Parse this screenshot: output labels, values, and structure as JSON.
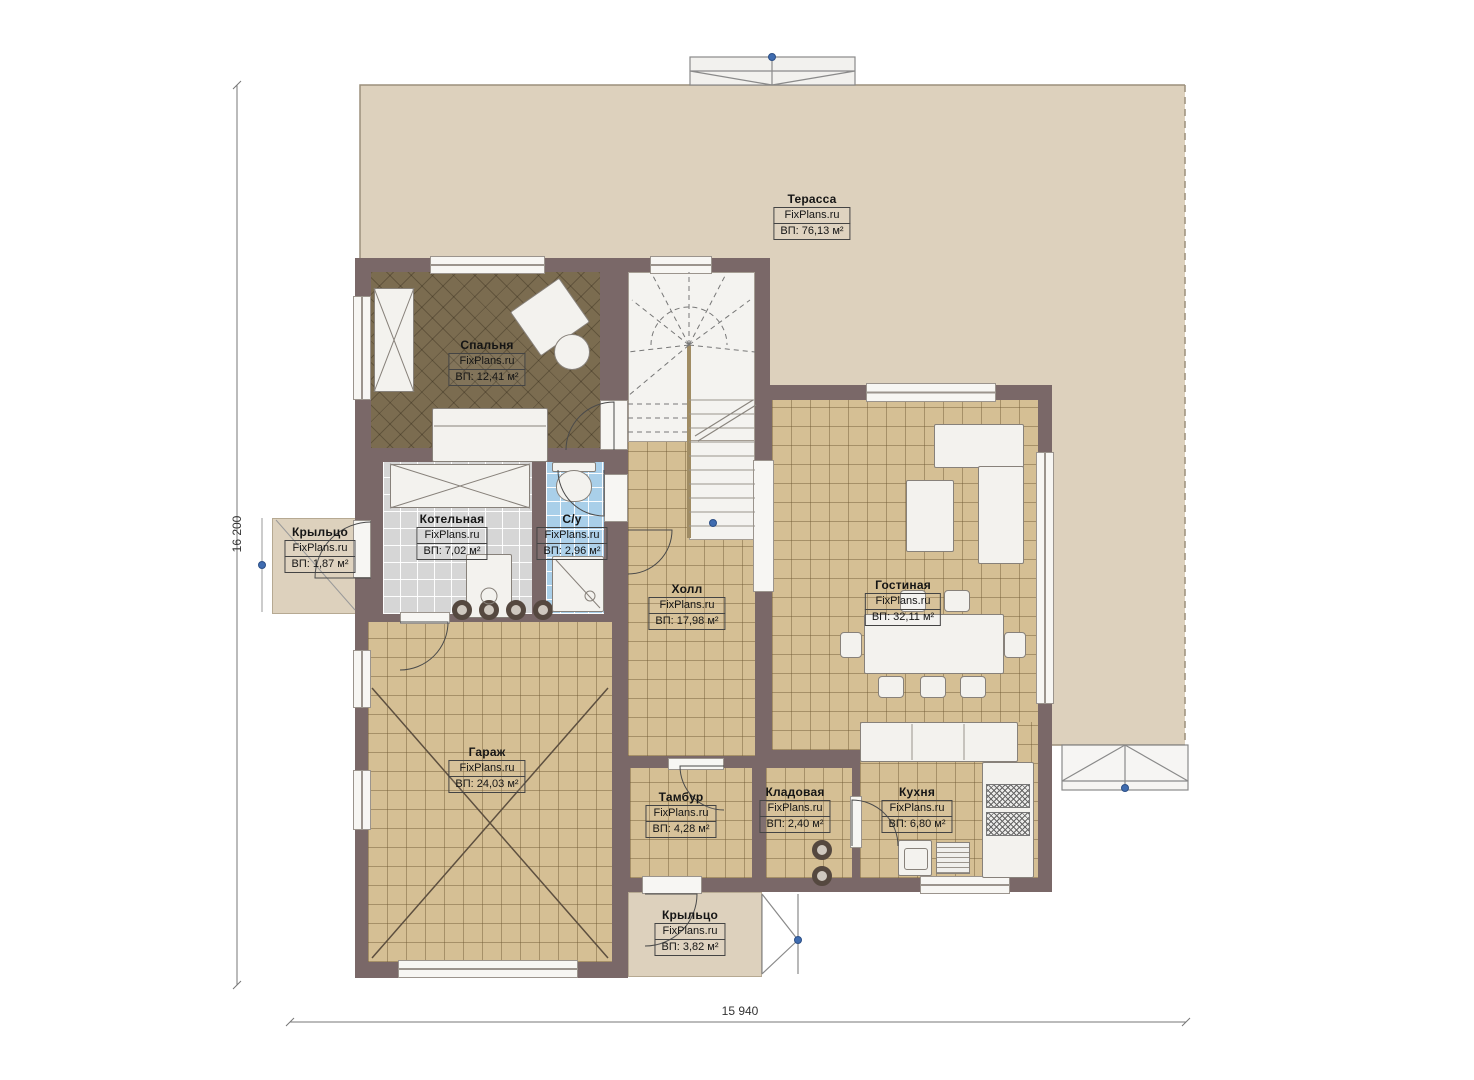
{
  "plan": {
    "watermark": "FixPlans.ru",
    "rooms": [
      {
        "id": "terrace",
        "name": "Терасса",
        "area": "ВП: 76,13 м²"
      },
      {
        "id": "bedroom",
        "name": "Спальня",
        "area": "ВП: 12,41 м²"
      },
      {
        "id": "boiler-room",
        "name": "Котельная",
        "area": "ВП: 7,02 м²"
      },
      {
        "id": "bathroom",
        "name": "С/у",
        "area": "ВП: 2,96 м²"
      },
      {
        "id": "hall",
        "name": "Холл",
        "area": "ВП: 17,98 м²"
      },
      {
        "id": "living-room",
        "name": "Гостиная",
        "area": "ВП: 32,11 м²"
      },
      {
        "id": "garage",
        "name": "Гараж",
        "area": "ВП: 24,03 м²"
      },
      {
        "id": "vestibule",
        "name": "Тамбур",
        "area": "ВП: 4,28 м²"
      },
      {
        "id": "storage",
        "name": "Кладовая",
        "area": "ВП: 2,40 м²"
      },
      {
        "id": "kitchen",
        "name": "Кухня",
        "area": "ВП: 6,80 м²"
      },
      {
        "id": "porch-left",
        "name": "Крыльцо",
        "area": "ВП: 1,87 м²"
      },
      {
        "id": "porch-bottom",
        "name": "Крыльцо",
        "area": "ВП: 3,82 м²"
      }
    ],
    "dimensions": {
      "height": "16 200",
      "width": "15 940"
    },
    "colors": {
      "wall": "#7a6868",
      "terrace": "#ddd1bd",
      "floor_tan": "#d5bf94",
      "floor_gray": "#d6d6d6",
      "floor_blue": "#a9cfe9",
      "floor_bedroom": "#7b6c50",
      "marker_blue": "#3f6cb0"
    }
  }
}
